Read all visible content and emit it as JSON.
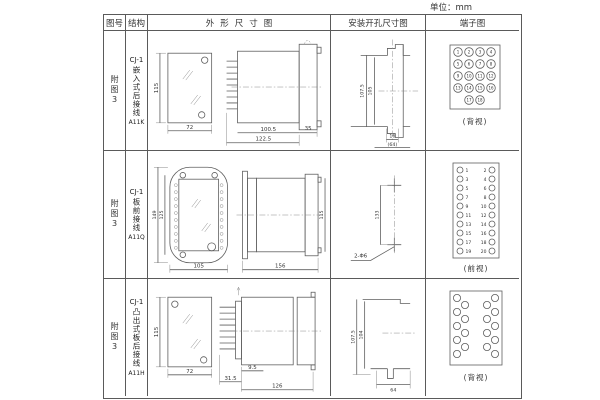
{
  "unit_label": "单位：mm",
  "headers": {
    "fig_no": "图号",
    "structure": "结构",
    "outline": "外形尺寸图",
    "install": "安装开孔尺寸图",
    "terminal": "端子图"
  },
  "rows": [
    {
      "fig_no": "附图3",
      "structure": {
        "model": "CJ-1",
        "desc": "嵌入式后接线",
        "code": "A11K"
      },
      "outline": {
        "front_height": "115",
        "front_width": "72",
        "body_length": "100.5",
        "total_length": "122.5",
        "flange_depth": "35"
      },
      "install": {
        "outer_height": "107.5",
        "inner_height": "105",
        "slot_width": "16",
        "span": "(64)"
      },
      "terminal": {
        "view": "(背视)",
        "numbers": [
          "1",
          "2",
          "3",
          "4",
          "5",
          "6",
          "7",
          "8",
          "9",
          "10",
          "11",
          "12",
          "13",
          "14",
          "15",
          "16",
          "17",
          "18"
        ]
      }
    },
    {
      "fig_no": "附图3",
      "structure": {
        "model": "CJ-1",
        "desc": "板前接线",
        "code": "A11Q"
      },
      "outline": {
        "outer_height": "149",
        "inner_height": "125",
        "width": "105",
        "body_length": "156",
        "side_height": "115"
      },
      "install": {
        "hole_spacing": "133",
        "hole_label": "2-Φ6"
      },
      "terminal": {
        "view": "(前视)",
        "left": [
          "1",
          "3",
          "5",
          "7",
          "9",
          "11",
          "13",
          "15",
          "17",
          "19"
        ],
        "right": [
          "2",
          "4",
          "6",
          "8",
          "10",
          "12",
          "14",
          "16",
          "18",
          "20"
        ]
      }
    },
    {
      "fig_no": "附图3",
      "structure": {
        "model": "CJ-1",
        "desc": "凸出式板后接线",
        "code": "A11H"
      },
      "outline": {
        "front_height": "115",
        "front_width": "72",
        "pin_length": "31.5",
        "offset": "9.5",
        "body_length": "126"
      },
      "install": {
        "outer_height": "107.5",
        "inner_height": "104",
        "span": "64"
      },
      "terminal": {
        "view": "(背视)"
      }
    }
  ]
}
